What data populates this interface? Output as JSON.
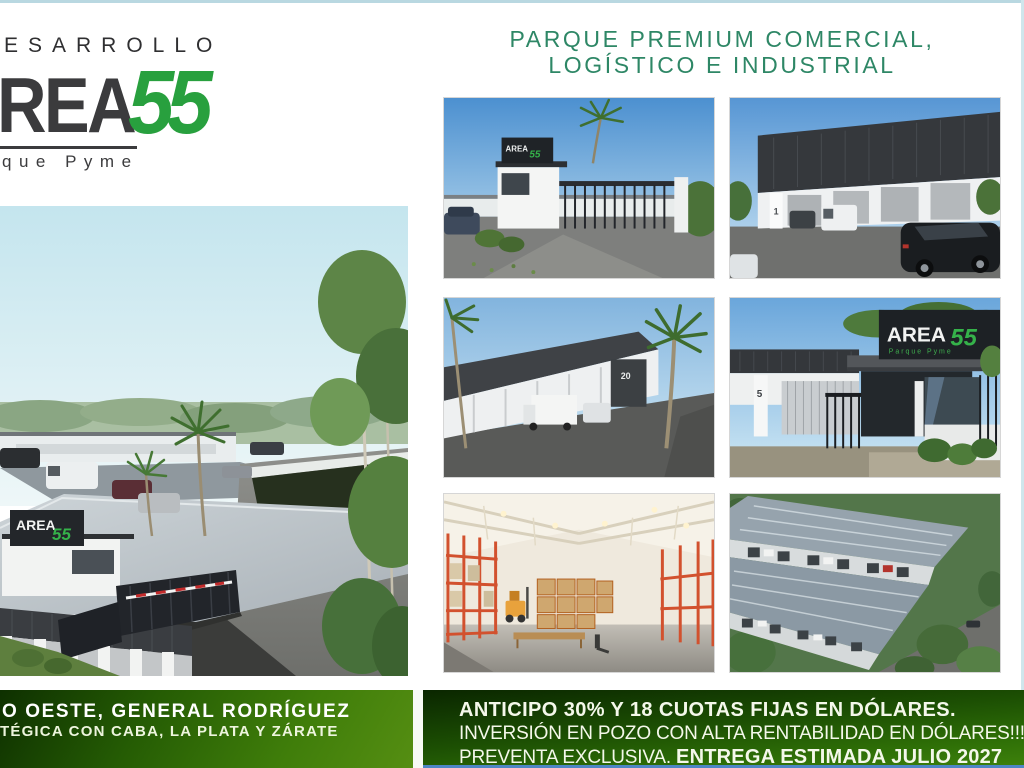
{
  "page": {
    "colors": {
      "brand_green": "#28a03e",
      "heading_green": "#2e8766",
      "logo_dark": "#3b3b3d",
      "band_green_dark": "#0e3000",
      "band_green_light": "#558e12",
      "bottom_blue_line": "#4d86c5",
      "frame_aqua": "#b9d8e1"
    }
  },
  "brand": {
    "developer_label": "ESARROLLO",
    "logo_main": "REA",
    "logo_number": "55",
    "logo_sub": "que Pyme"
  },
  "heading": {
    "line1": "PARQUE PREMIUM COMERCIAL,",
    "line2": "LOGÍSTICO E INDUSTRIAL"
  },
  "main_render": {
    "desc": "aerial render of warehouse park entrance with palm trees and parked cars",
    "sign_area": "AREA",
    "sign_55": "55",
    "unit_number": "5"
  },
  "gallery": {
    "thumb1": {
      "desc": "entrance gatehouse street render",
      "sign_area": "AREA",
      "sign_55": "55"
    },
    "thumb2": {
      "desc": "warehouse facade row with vehicles",
      "unit": "1"
    },
    "thumb3": {
      "desc": "warehouse row with palm trees and truck",
      "unit": "20"
    },
    "thumb4": {
      "desc": "gatehouse close-up with brand sign",
      "unit": "5",
      "sign_area": "AREA",
      "sign_55": "55",
      "sign_sub": "Parque Pyme"
    },
    "thumb5": {
      "desc": "warehouse interior with orange racking"
    },
    "thumb6": {
      "desc": "aerial view of warehouse roofs and loading docks"
    }
  },
  "footer_left": {
    "line1": "O OESTE, GENERAL RODRÍGUEZ",
    "line2": "TÉGICA CON CABA, LA PLATA Y ZÁRATE"
  },
  "footer_right": {
    "line1": "ANTICIPO 30% Y 18 CUOTAS FIJAS EN DÓLARES.",
    "line2": "INVERSIÓN EN POZO CON ALTA RENTABILIDAD EN DÓLARES!!!",
    "line3_regular": "PREVENTA EXCLUSIVA. ",
    "line3_bold": "ENTREGA ESTIMADA JULIO 2027"
  }
}
